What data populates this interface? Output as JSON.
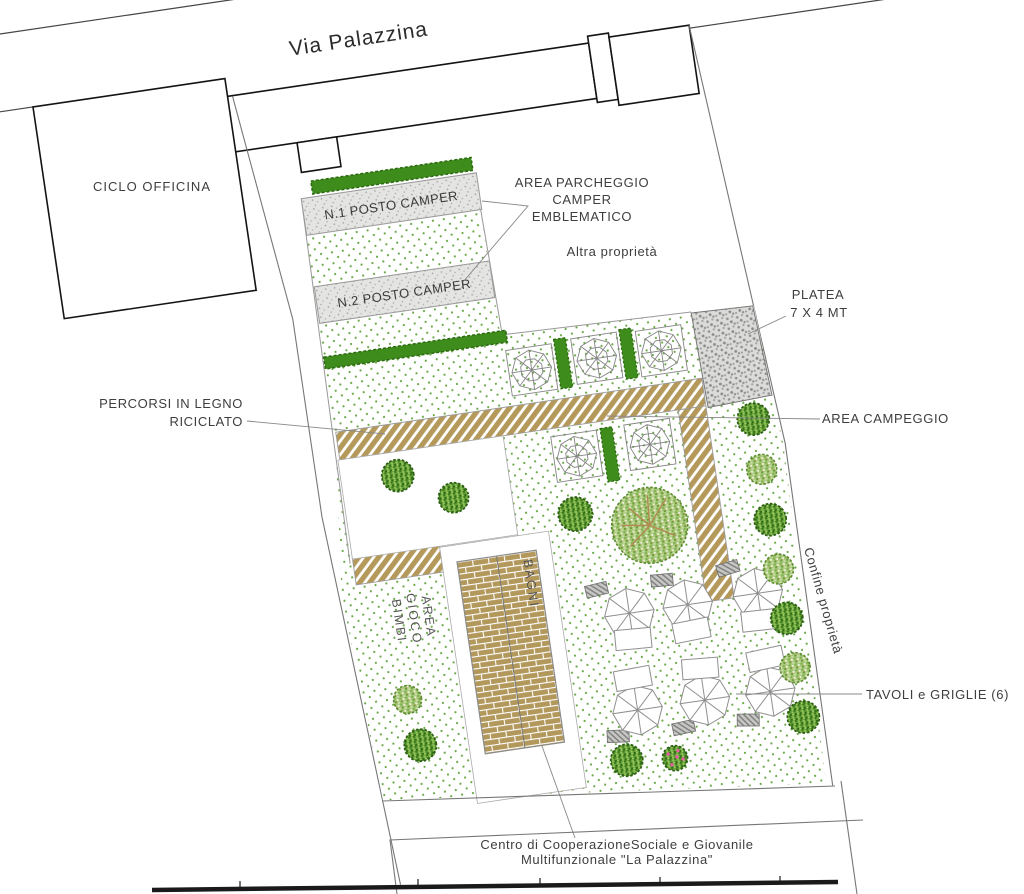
{
  "street": {
    "name": "Via Palazzina"
  },
  "buildings": {
    "ciclo_officina": "CICLO OFFICINA",
    "bagni": "BAGNI",
    "centro_line1": "Centro di CooperazioneSociale e Giovanile",
    "centro_line2": "Multifunzionale \"La Palazzina\""
  },
  "camper_area": {
    "slot1": "N.1 POSTO CAMPER",
    "slot2": "N.2 POSTO CAMPER",
    "callout": {
      "line1": "AREA PARCHEGGIO",
      "line2": "CAMPER",
      "line3": "EMBLEMATICO"
    }
  },
  "annotations": {
    "altra_proprieta": "Altra proprietà",
    "platea_line1": "PLATEA",
    "platea_line2": "7 X 4 MT",
    "percorsi_line1": "PERCORSI IN LEGNO",
    "percorsi_line2": "RICICLATO",
    "area_campeggio": "AREA CAMPEGGIO",
    "confine_proprieta": "Confine proprietà",
    "gioco_line1": "AREA",
    "gioco_line2": "GIOCO",
    "gioco_line3": "BIMBI",
    "tavoli_griglie": "TAVOLI e GRIGLIE (6)"
  },
  "colors": {
    "wood_path": "#b4995b",
    "hedge_green": "#3e8c1c",
    "ground_dot_green": "#69a746",
    "tree_dark": "#3c7a1d",
    "tree_light": "#8fc457",
    "flower_pink": "#e75ba0",
    "gravel_gray": "#dbdbd9",
    "line_gray": "#777777",
    "building_outline": "#141414",
    "text_gray": "#3e3e3e"
  }
}
